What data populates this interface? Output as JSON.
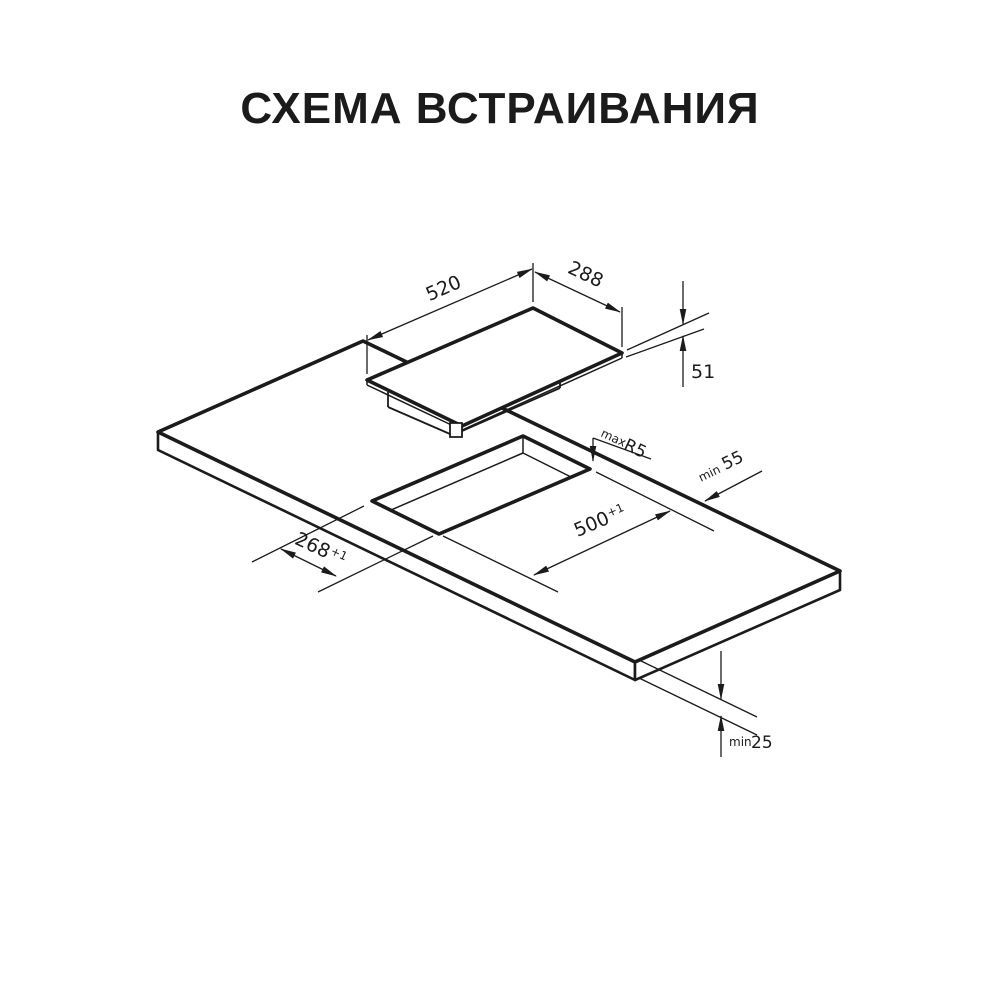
{
  "title": "СХЕМА ВСТРАИВАНИЯ",
  "colors": {
    "ink": "#1b1b1b",
    "background": "#ffffff"
  },
  "hob": {
    "width": "520",
    "depth": "288",
    "height": "51"
  },
  "cutout": {
    "length": "500",
    "length_tol": "+1",
    "width": "268",
    "width_tol": "+1",
    "radius_prefix": "max",
    "radius": "R5",
    "side_clearance_prefix": "min",
    "side_clearance": "55",
    "thickness_prefix": "min",
    "thickness": "25"
  }
}
